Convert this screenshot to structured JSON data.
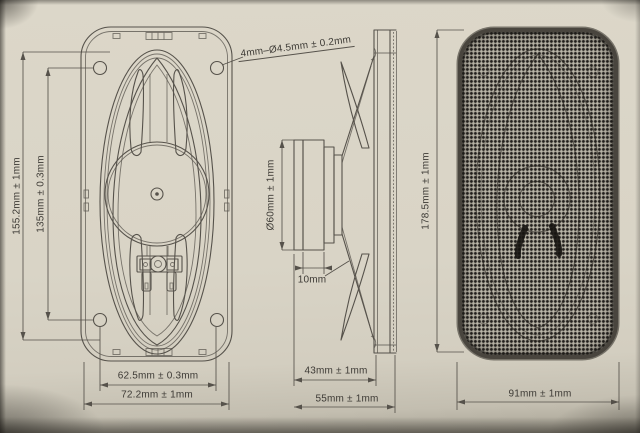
{
  "colors": {
    "paper": "#dcd7c9",
    "line": "#56524b",
    "ink": "#3d3a35",
    "mesh-base": "#969287",
    "mesh-rim": "#49453e"
  },
  "dimensions": {
    "rear_view": {
      "height": "155.2mm ± 1mm",
      "hole_spacing_vertical": "135mm ± 0.3mm",
      "hole_spacing_horizontal": "62.5mm ± 0.3mm",
      "width": "72.2mm ± 1mm",
      "mounting_holes_note": "4mm–Ø4.5mm ± 0.2mm"
    },
    "side_view": {
      "magnet_diameter": "Ø60mm ± 1mm",
      "magnet_thickness": "10mm",
      "mounting_depth": "43mm ± 1mm",
      "overall_depth": "55mm ± 1mm"
    },
    "front_view": {
      "height": "178.5mm ± 1mm",
      "width": "91mm ± 1mm"
    }
  }
}
